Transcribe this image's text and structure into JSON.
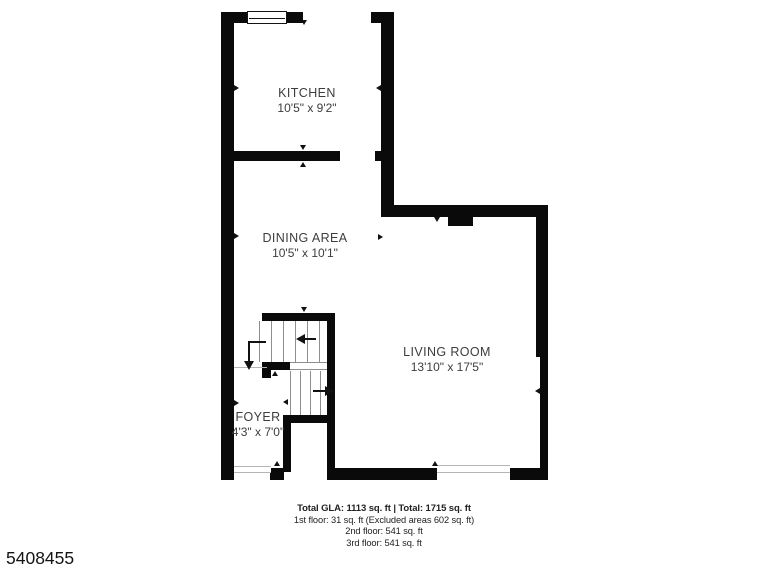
{
  "page": {
    "background": "#ffffff",
    "listing_id": "5408455"
  },
  "rooms": [
    {
      "name": "KITCHEN",
      "dimensions": "10'5\" x 9'2\""
    },
    {
      "name": "DINING AREA",
      "dimensions": "10'5\" x 10'1\""
    },
    {
      "name": "LIVING ROOM",
      "dimensions": "13'10\" x 17'5\""
    },
    {
      "name": "FOYER",
      "dimensions": "4'3\" x 7'0\""
    }
  ],
  "summary": {
    "total_line": "Total GLA: 1113 sq. ft | Total: 1715 sq. ft",
    "floor_lines": [
      "1st floor: 31 sq. ft (Excluded areas 602 sq. ft)",
      "2nd floor: 541 sq. ft",
      "3rd floor: 541 sq. ft"
    ]
  },
  "colors": {
    "wall": "#0a0a0a",
    "label_text": "#3d3d3d",
    "window_line": "#b5b5b5",
    "tread_line": "#8e8e8e"
  }
}
